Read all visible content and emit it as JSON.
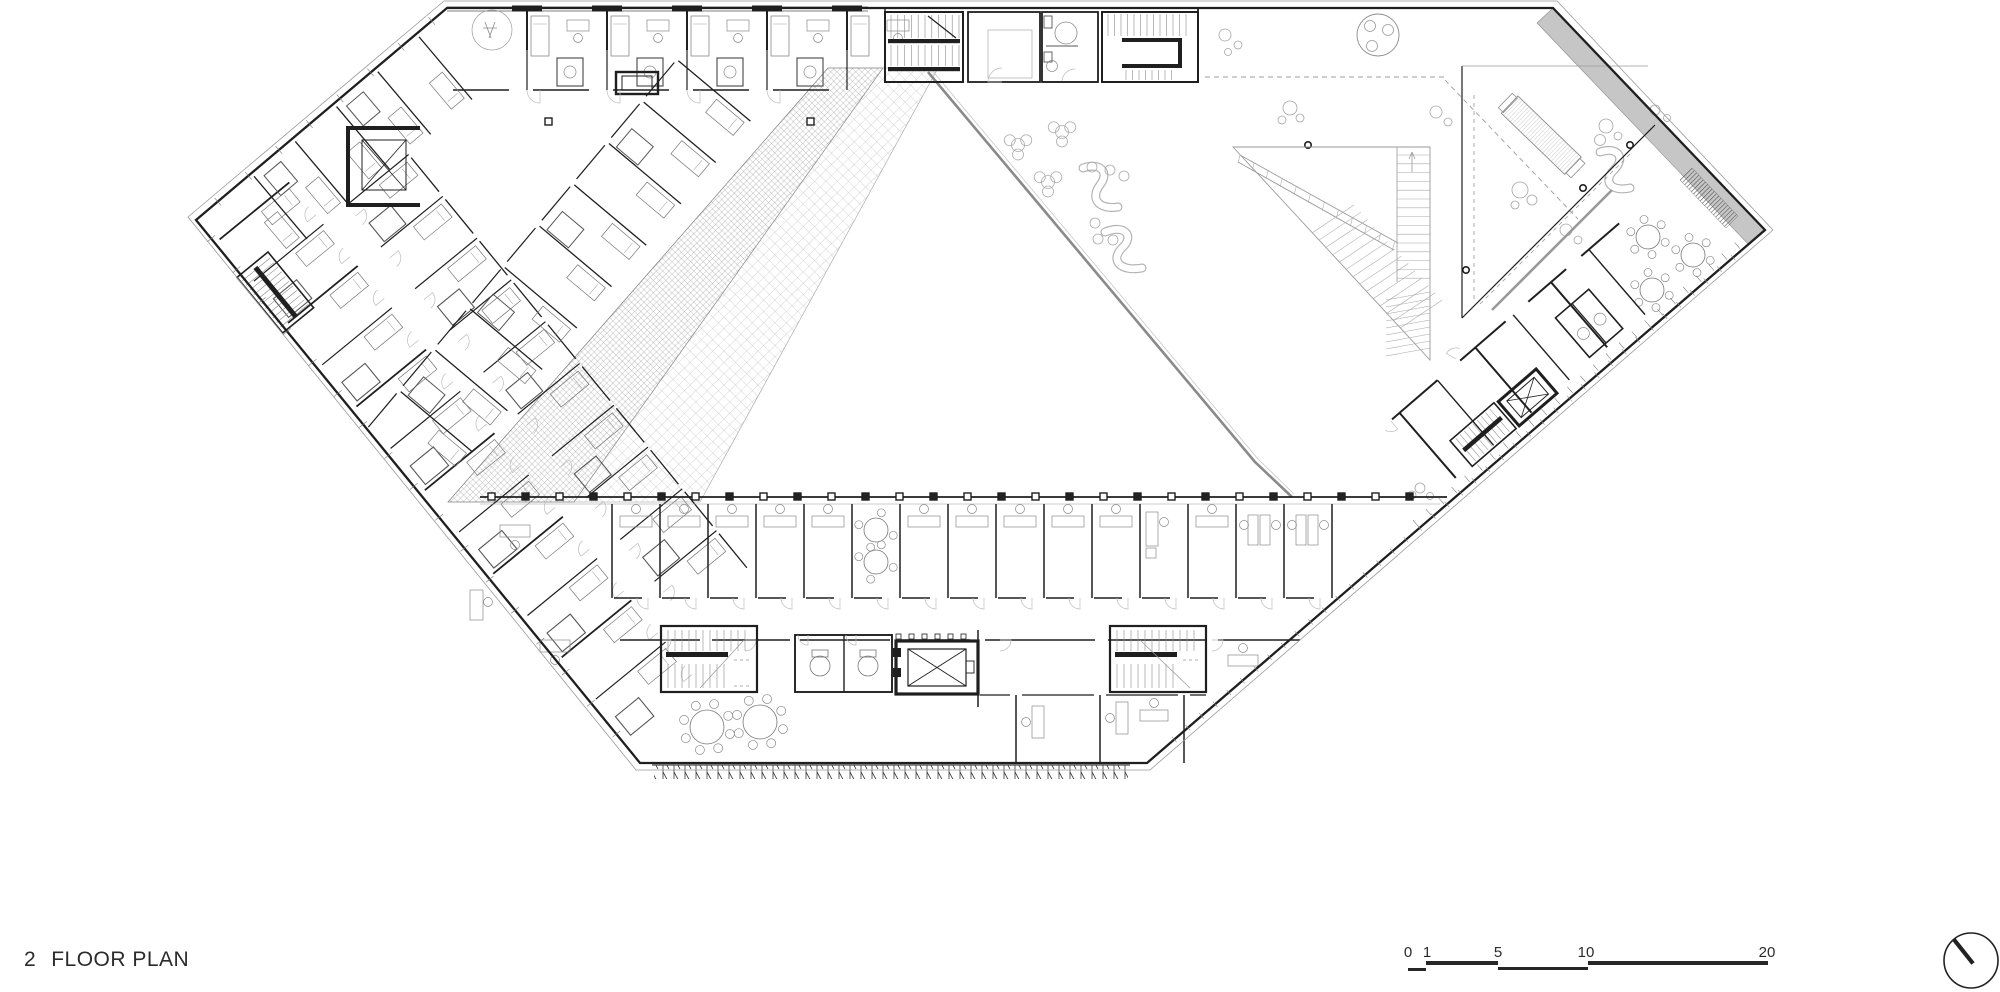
{
  "title": {
    "number": "2",
    "text": "FLOOR PLAN"
  },
  "scale_bar": {
    "labels": [
      "0",
      "1",
      "5",
      "10",
      "20"
    ]
  },
  "north_arrow": {
    "icon": "north-arrow-icon"
  },
  "colors": {
    "ink": "#1f1f1f",
    "mid": "#555555",
    "light": "#9a9a9a",
    "faint": "#bcbcbc",
    "gray_fill": "#c6c6c6",
    "paper": "#ffffff"
  }
}
